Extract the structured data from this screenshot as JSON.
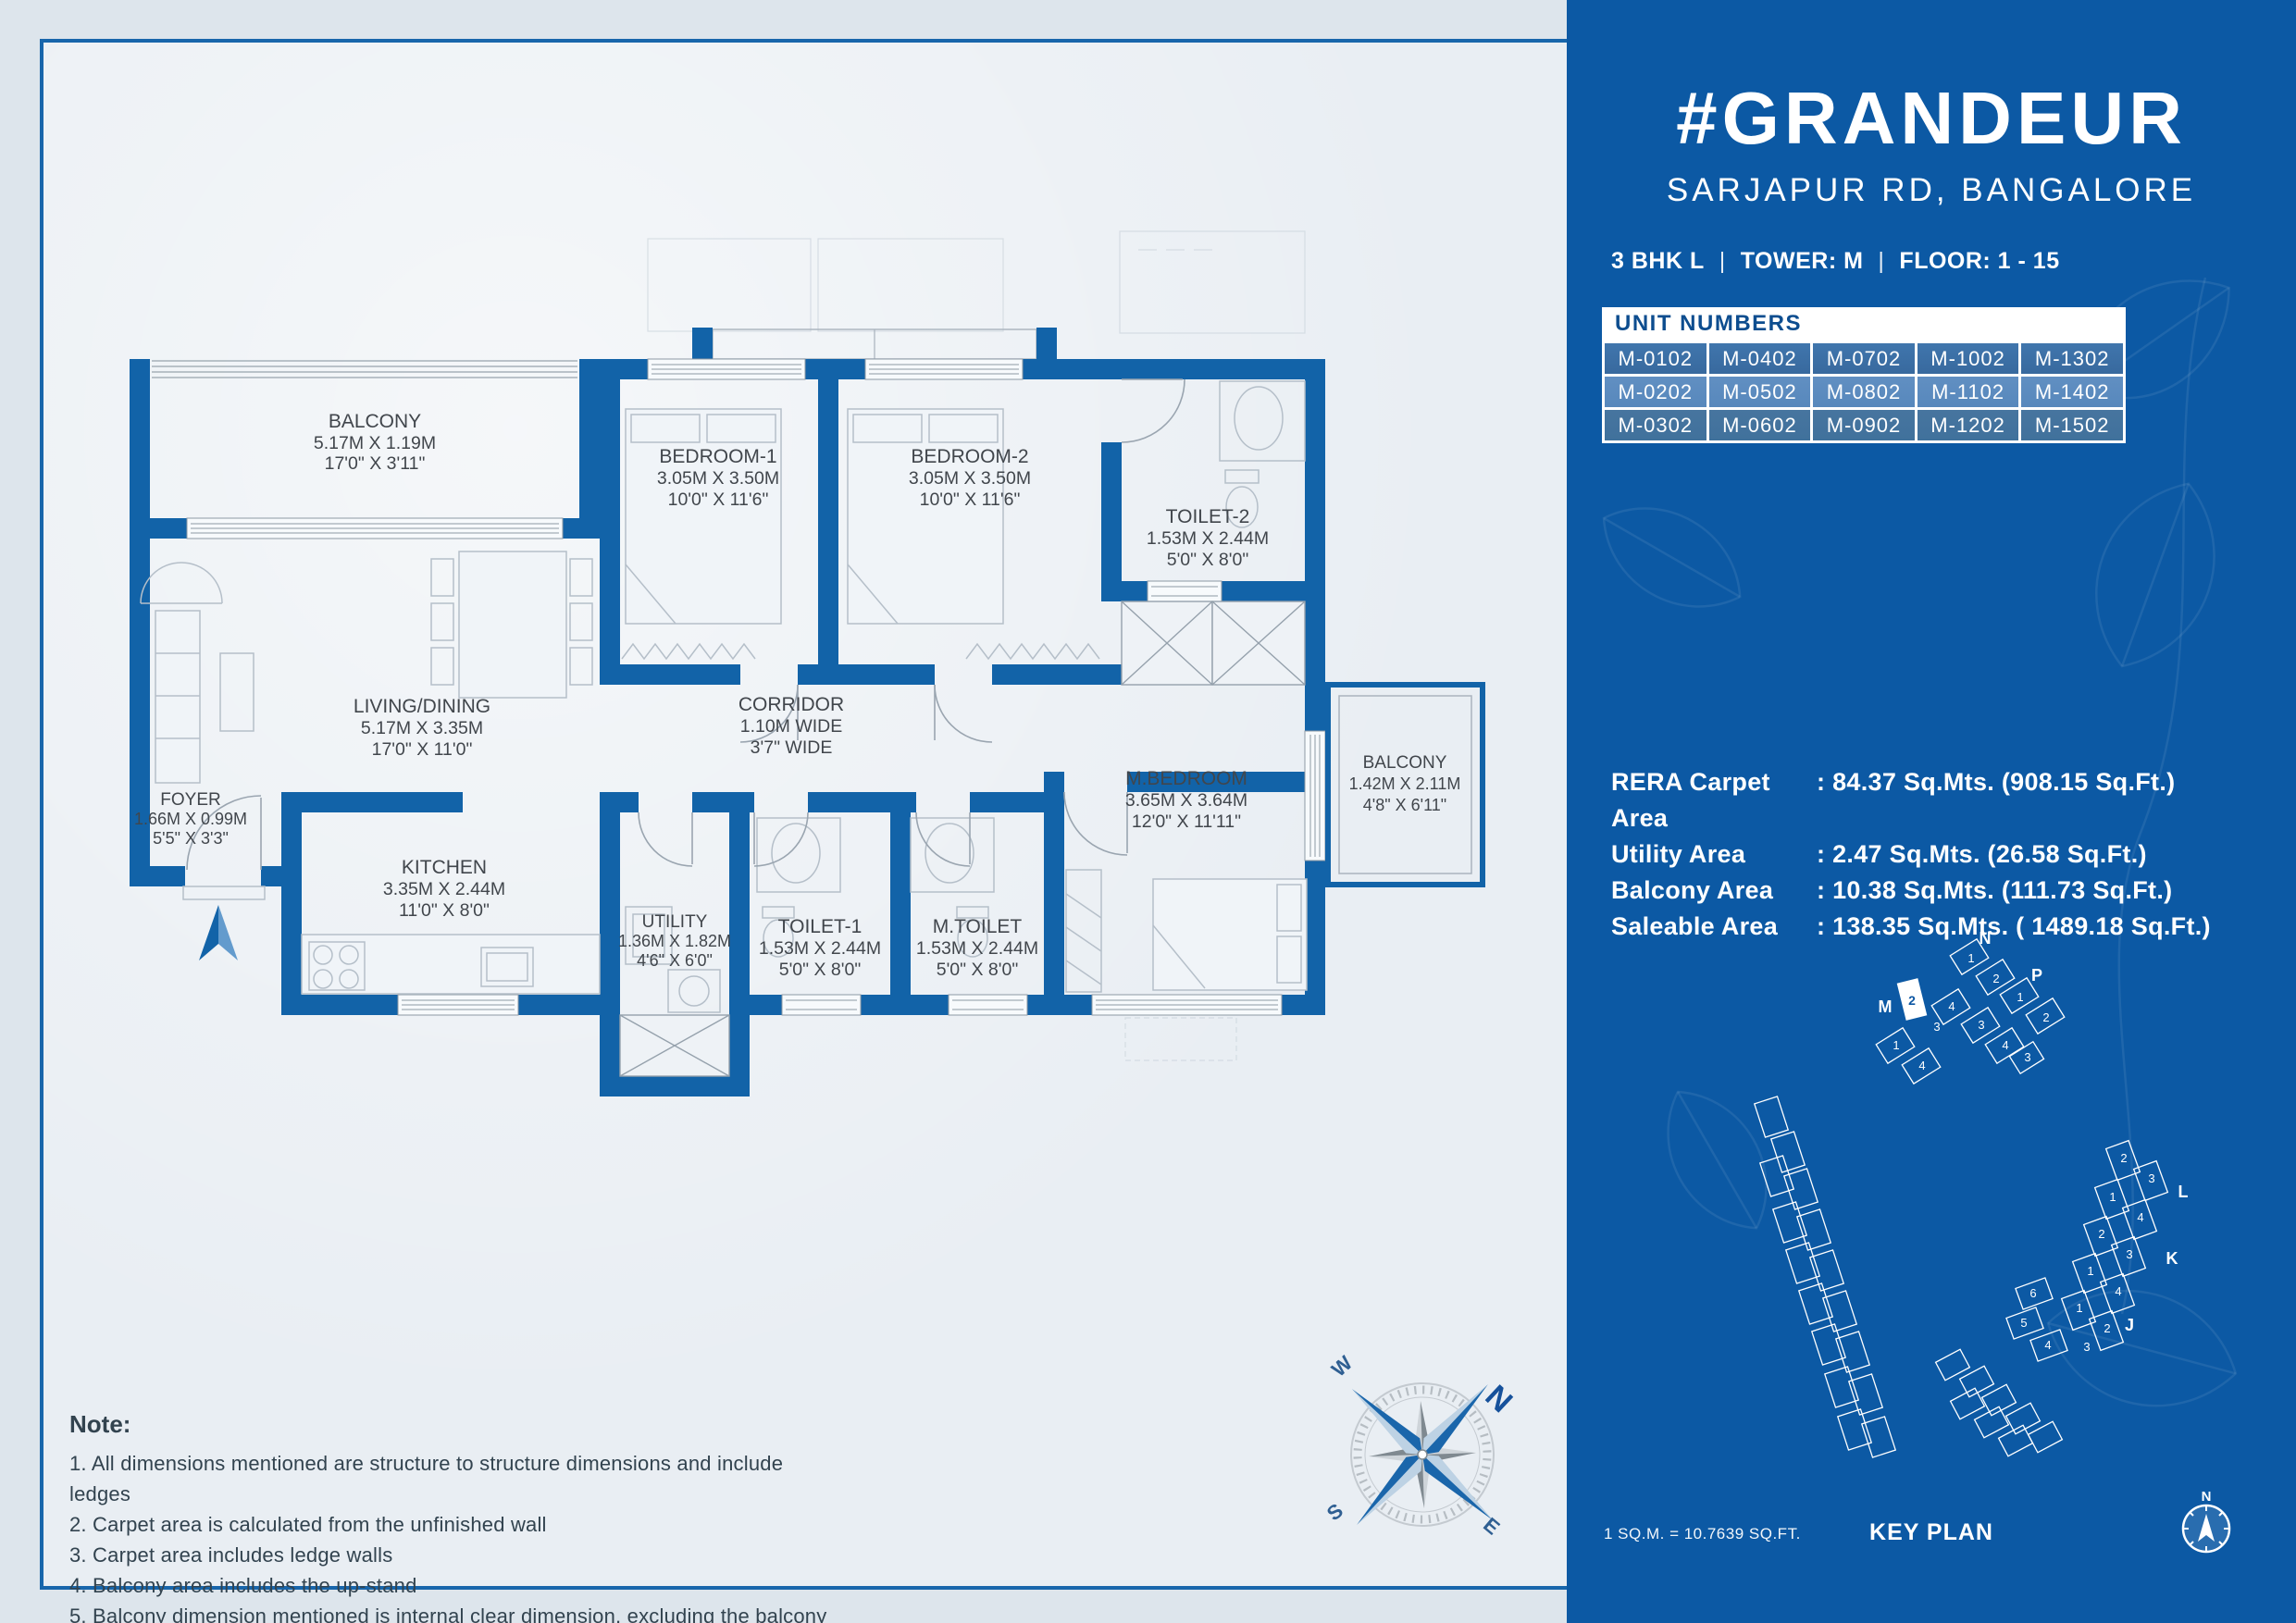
{
  "plan": {
    "rooms": [
      {
        "name": "BALCONY",
        "metric": "5.17M X 1.19M",
        "imperial": "17'0\" X 3'11\""
      },
      {
        "name": "BEDROOM-1",
        "metric": "3.05M X 3.50M",
        "imperial": "10'0\" X 11'6\""
      },
      {
        "name": "BEDROOM-2",
        "metric": "3.05M X 3.50M",
        "imperial": "10'0\" X 11'6\""
      },
      {
        "name": "TOILET-2",
        "metric": "1.53M X 2.44M",
        "imperial": "5'0\" X 8'0\""
      },
      {
        "name": "LIVING/DINING",
        "metric": "5.17M X 3.35M",
        "imperial": "17'0\" X 11'0\""
      },
      {
        "name": "CORRIDOR",
        "metric": "1.10M WIDE",
        "imperial": "3'7\" WIDE"
      },
      {
        "name": "FOYER",
        "metric": "1.66M X 0.99M",
        "imperial": "5'5\" X 3'3\""
      },
      {
        "name": "KITCHEN",
        "metric": "3.35M X 2.44M",
        "imperial": "11'0\" X 8'0\""
      },
      {
        "name": "UTILITY",
        "metric": "1.36M X 1.82M",
        "imperial": "4'6\" X 6'0\""
      },
      {
        "name": "TOILET-1",
        "metric": "1.53M X 2.44M",
        "imperial": "5'0\" X 8'0\""
      },
      {
        "name": "M.TOILET",
        "metric": "1.53M X 2.44M",
        "imperial": "5'0\" X 8'0\""
      },
      {
        "name": "M.BEDROOM",
        "metric": "3.65M X 3.64M",
        "imperial": "12'0\" X 11'11\""
      },
      {
        "name": "BALCONY",
        "metric": "1.42M X 2.11M",
        "imperial": "4'8\" X 6'11\""
      }
    ],
    "compass": {
      "n": "N",
      "e": "E",
      "s": "S",
      "w": "W"
    },
    "note": {
      "heading": "Note:",
      "items": [
        "1. All dimensions mentioned are structure to structure dimensions and include ledges",
        "2. Carpet area is calculated from the unfinished wall",
        "3. Carpet area includes ledge walls",
        "4. Balcony area includes the up-stand",
        "5. Balcony dimension mentioned is internal clear dimension, excluding the balcony up-stand"
      ]
    }
  },
  "panel": {
    "title": "#GRANDEUR",
    "subtitle": "SARJAPUR RD, BANGALORE",
    "spec": {
      "type": "3 BHK L",
      "tower": "TOWER: M",
      "floor": "FLOOR: 1 - 15",
      "separator": "|"
    },
    "unit_table": {
      "header": "UNIT NUMBERS",
      "rows": [
        [
          "M-0102",
          "M-0402",
          "M-0702",
          "M-1002",
          "M-1302"
        ],
        [
          "M-0202",
          "M-0502",
          "M-0802",
          "M-1102",
          "M-1402"
        ],
        [
          "M-0302",
          "M-0602",
          "M-0902",
          "M-1202",
          "M-1502"
        ]
      ]
    },
    "areas": [
      {
        "label": "RERA Carpet Area",
        "value": ": 84.37 Sq.Mts. (908.15 Sq.Ft.)"
      },
      {
        "label": "Utility Area",
        "value": ": 2.47 Sq.Mts. (26.58 Sq.Ft.)"
      },
      {
        "label": "Balcony Area",
        "value": ": 10.38 Sq.Mts. (111.73 Sq.Ft.)"
      },
      {
        "label": "Saleable Area",
        "value": ": 138.35 Sq.Mts. ( 1489.18 Sq.Ft.)"
      }
    ],
    "key_plan": {
      "title": "KEY PLAN",
      "scale_note": "1 SQ.M. = 10.7639 SQ.FT.",
      "towers": {
        "n": "N",
        "p": "P",
        "m": "M",
        "l": "L",
        "k": "K",
        "j": "J"
      },
      "highlighted_unit": "2",
      "compass_n": "N",
      "top_units": [
        "1",
        "2",
        "1",
        "2",
        "4",
        "3",
        "3",
        "4",
        "3",
        "1",
        "4"
      ],
      "right_units": [
        "2",
        "3",
        "1",
        "4",
        "2",
        "3",
        "1",
        "4",
        "1",
        "2",
        "3",
        "6",
        "5",
        "4"
      ]
    }
  },
  "colors": {
    "panel_blue": "#0c59a4",
    "wall_blue": "#1263a8",
    "border_blue": "#1866ab",
    "paper": "#e9eef3",
    "page_bg": "#dce4ec",
    "table_row_dark": "#38699e",
    "table_row_light": "#5788bc",
    "table_row_mid": "#40719c",
    "table_header_text": "#0d4d8f",
    "plan_label_text": "#41464c"
  }
}
